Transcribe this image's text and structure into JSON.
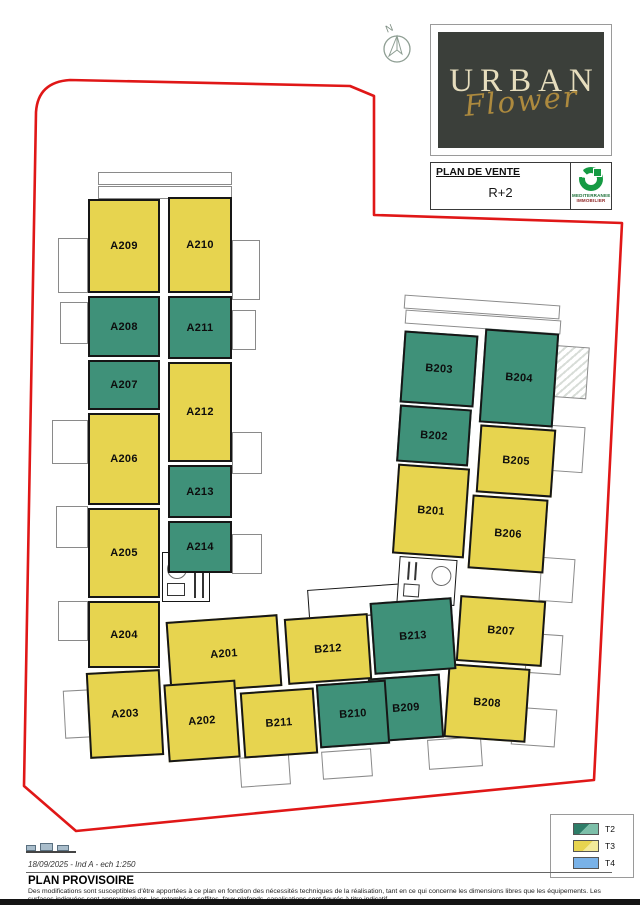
{
  "header": {
    "project": "URBAN",
    "project_sub": "Flower",
    "doc_title": "PLAN DE VENTE",
    "level": "R+2",
    "agency_line1": "MEDITERRANEE",
    "agency_line2": "IMMOBILIER"
  },
  "north": {
    "label": "N"
  },
  "colors": {
    "t2_green": "#3f9179",
    "t3_yellow": "#e7d44f",
    "t4_blue": "#79b2e8",
    "boundary_red": "#e01717",
    "logo_bg": "#3b3f3a",
    "logo_gold": "#ad8a3e"
  },
  "legend": {
    "items": [
      {
        "label": "T2",
        "color": "#3f9179"
      },
      {
        "label": "T3",
        "color": "#e7d44f"
      },
      {
        "label": "T4",
        "color": "#79b2e8"
      }
    ]
  },
  "units": [
    {
      "id": "A201",
      "label": "A201",
      "type": "T3"
    },
    {
      "id": "A202",
      "label": "A202",
      "type": "T3"
    },
    {
      "id": "A203",
      "label": "A203",
      "type": "T3"
    },
    {
      "id": "A204",
      "label": "A204",
      "type": "T3"
    },
    {
      "id": "A205",
      "label": "A205",
      "type": "T3"
    },
    {
      "id": "A206",
      "label": "A206",
      "type": "T3"
    },
    {
      "id": "A207",
      "label": "A207",
      "type": "T2"
    },
    {
      "id": "A208",
      "label": "A208",
      "type": "T2"
    },
    {
      "id": "A209",
      "label": "A209",
      "type": "T3"
    },
    {
      "id": "A210",
      "label": "A210",
      "type": "T3"
    },
    {
      "id": "A211",
      "label": "A211",
      "type": "T2"
    },
    {
      "id": "A212",
      "label": "A212",
      "type": "T3"
    },
    {
      "id": "A213",
      "label": "A213",
      "type": "T2"
    },
    {
      "id": "A214",
      "label": "A214",
      "type": "T2"
    },
    {
      "id": "B201",
      "label": "B201",
      "type": "T3"
    },
    {
      "id": "B202",
      "label": "B202",
      "type": "T2"
    },
    {
      "id": "B203",
      "label": "B203",
      "type": "T2"
    },
    {
      "id": "B204",
      "label": "B204",
      "type": "T2"
    },
    {
      "id": "B205",
      "label": "B205",
      "type": "T3"
    },
    {
      "id": "B206",
      "label": "B206",
      "type": "T3"
    },
    {
      "id": "B207",
      "label": "B207",
      "type": "T3"
    },
    {
      "id": "B208",
      "label": "B208",
      "type": "T3"
    },
    {
      "id": "B209",
      "label": "B209",
      "type": "T2"
    },
    {
      "id": "B210",
      "label": "B210",
      "type": "T2"
    },
    {
      "id": "B211",
      "label": "B211",
      "type": "T3"
    },
    {
      "id": "B212",
      "label": "B212",
      "type": "T3"
    },
    {
      "id": "B213",
      "label": "B213",
      "type": "T2"
    }
  ],
  "footer": {
    "revision": "18/09/2025 - Ind A - ech 1:250",
    "title": "PLAN PROVISOIRE",
    "disclaimer": "Des modifications sont susceptibles d'être apportées à ce plan en fonction des nécessités techniques de la réalisation, tant en ce qui concerne les dimensions libres que les équipements. Les surfaces indiquées sont approximatives, les retombées, soffites, faux-plafonds, canalisations sont figurés à titre indicatif."
  }
}
